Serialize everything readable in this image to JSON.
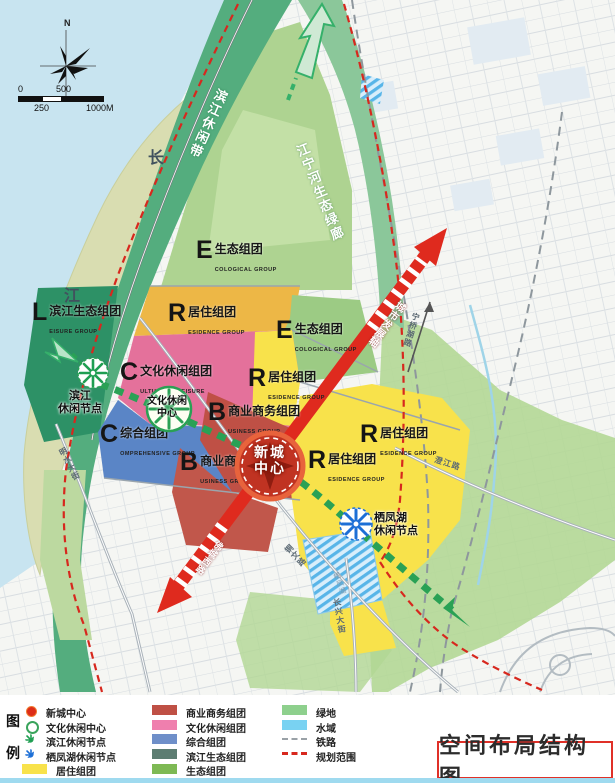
{
  "title_box": "空间布局结构图",
  "compass": {
    "north": "N"
  },
  "scalebar": {
    "t0": "0",
    "t250": "250",
    "t500": "500",
    "t1000": "1000M"
  },
  "map": {
    "river": {
      "char1": "长",
      "char2": "江"
    },
    "corridors": {
      "binjiang_belt": "滨江休闲带",
      "jiangning_corridor": "江宁河生态绿廊"
    },
    "axis": {
      "label_upper": "城市发展轴",
      "label_lower": "佛城西路"
    },
    "zones": [
      {
        "letter": "E",
        "name": "生态组团",
        "sub": "COLOGICAL GROUP"
      },
      {
        "letter": "L",
        "name": "滨江生态组团",
        "sub": "EISURE GROUP"
      },
      {
        "letter": "R",
        "name": "居住组团",
        "sub": "ESIDENCE GROUP"
      },
      {
        "letter": "E",
        "name": "生态组团",
        "sub": "COLOGICAL GROUP"
      },
      {
        "letter": "C",
        "name": "文化休闲组团",
        "sub": "ULTURAL & LEISURE"
      },
      {
        "letter": "R",
        "name": "居住组团",
        "sub": "ESIDENCE GROUP"
      },
      {
        "letter": "B",
        "name": "商业商务组团",
        "sub": "USINESS GROUP"
      },
      {
        "letter": "C",
        "name": "综合组团",
        "sub": "OMPREHENSIVE GROUP"
      },
      {
        "letter": "B",
        "name": "商业商务",
        "sub": "USINESS GROUP"
      },
      {
        "letter": "R",
        "name": "居住组团",
        "sub": "ESIDENCE GROUP"
      },
      {
        "letter": "R",
        "name": "居住组团",
        "sub": "ESIDENCE GROUP"
      }
    ],
    "nodes": {
      "city_center": {
        "line1": "新城",
        "line2": "中心"
      },
      "culture_center": {
        "line1": "文化休闲",
        "line2": "中心"
      },
      "binjiang_node": {
        "line1": "滨江",
        "line2": "休闲节点"
      },
      "qifeng_node": {
        "line1": "栖凤湖",
        "line2": "休闲节点"
      }
    },
    "roads": {
      "mingshui": "明水大街",
      "tongwen": "铜文路",
      "changxing": "长兴大街",
      "chengjiang": "澄江路",
      "ningqiao": "宁桥湖路"
    },
    "lake": {
      "label": "栖凤湖"
    }
  },
  "legend": {
    "heading_chars": [
      "图",
      "例"
    ],
    "col1": [
      {
        "icon": "city-center-dot",
        "label": "新城中心"
      },
      {
        "icon": "culture-center-ring",
        "label": "文化休闲中心"
      },
      {
        "icon": "green-asterisk",
        "label": "滨江休闲节点"
      },
      {
        "icon": "blue-asterisk",
        "label": "栖凤湖休闲节点"
      },
      {
        "icon": "yellow-swatch",
        "label": "居住组团"
      }
    ],
    "col2": [
      {
        "icon": "brick-swatch",
        "label": "商业商务组团"
      },
      {
        "icon": "pink-swatch",
        "label": "文化休闲组团"
      },
      {
        "icon": "blue-swatch",
        "label": "综合组团"
      },
      {
        "icon": "graygreen-swatch",
        "label": "滨江生态组团"
      },
      {
        "icon": "green-swatch",
        "label": "生态组团"
      }
    ],
    "col3": [
      {
        "icon": "lightgreen-swatch",
        "label": "绿地"
      },
      {
        "icon": "lightblue-swatch",
        "label": "水域"
      },
      {
        "icon": "gray-dash",
        "label": "铁路"
      },
      {
        "icon": "red-dash",
        "label": "规划范围"
      }
    ]
  },
  "colors": {
    "water": "#c8e4f0",
    "land": "#f5f6f3",
    "axis_red": "#df2a1e",
    "leisure_green": "#2aa155",
    "residence_yellow": "#f8e24b",
    "business_brick": "#bf5045",
    "culture_pink": "#e4719b",
    "comprehensive_blue": "#5a85c6",
    "eco_green": "#aed391",
    "boundary_red": "#d7281e",
    "railway_gray": "#8e979d"
  }
}
